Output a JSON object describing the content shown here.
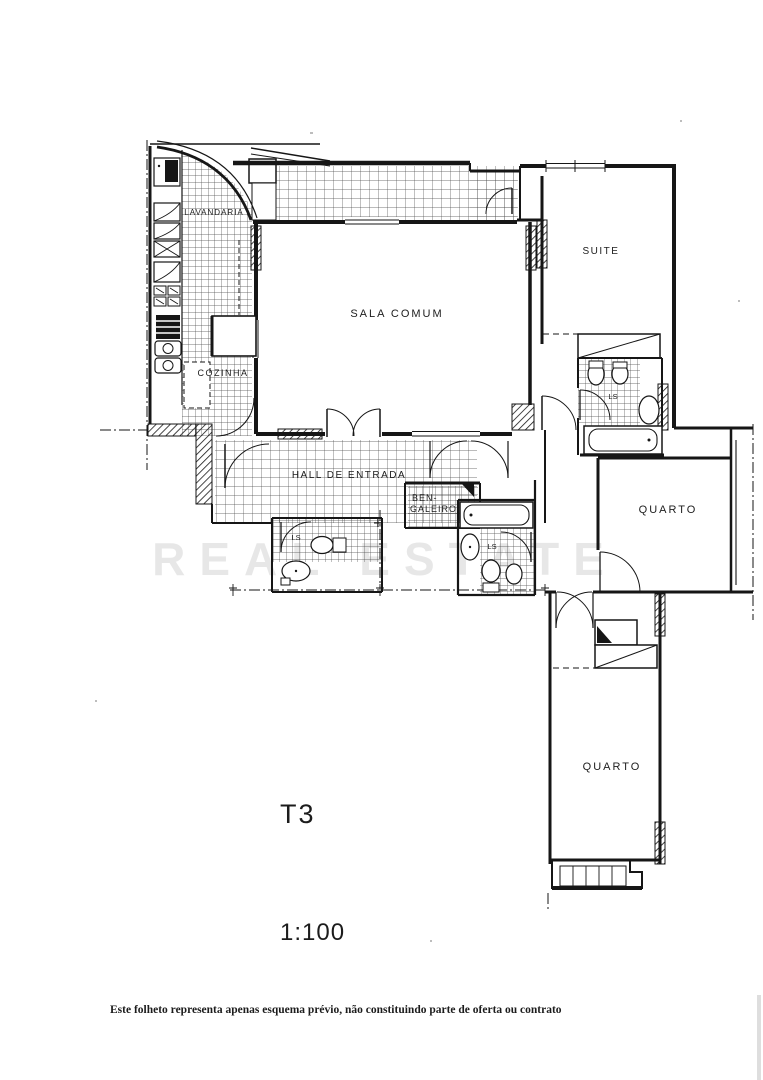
{
  "plan": {
    "labels": {
      "lavandaria": "LAVANDARIA",
      "cozinha": "COZINHA",
      "sala_comum": "SALA COMUM",
      "suite": "SUITE",
      "hall": "HALL DE ENTRADA",
      "bengaleiro_line1": "BEN-",
      "bengaleiro_line2": "GALEIRO",
      "quarto1": "QUARTO",
      "quarto2": "QUARTO",
      "ls": "LS"
    },
    "typology": "T3",
    "scale": "1:100",
    "watermark": "REAL ESTATE",
    "disclaimer": "Este folheto representa apenas esquema prévio, não constituindo parte de oferta ou contrato",
    "colors": {
      "ink": "#161616",
      "paper": "#ffffff"
    }
  }
}
